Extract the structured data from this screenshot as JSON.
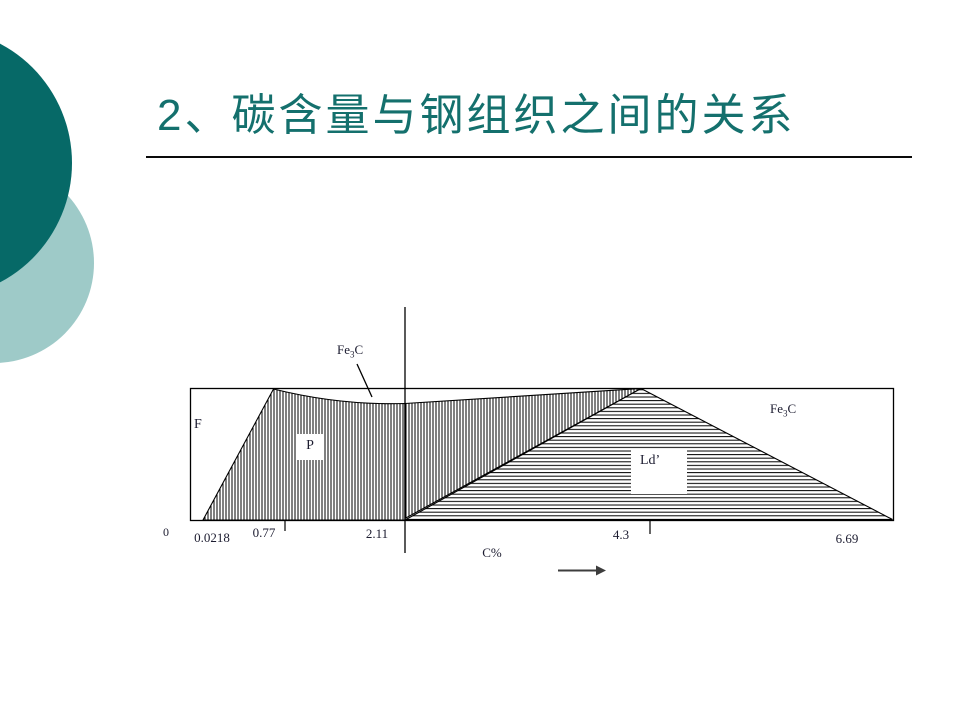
{
  "slide": {
    "title": "2、碳含量与钢组织之间的关系",
    "accent_color": "#14706d",
    "decor": {
      "dark_circle_color": "#066967",
      "light_circle_color": "#9ecac8"
    }
  },
  "diagram": {
    "description_labels": {
      "ferrite": "F",
      "pearlite": "P",
      "ledeburite": "Ld’",
      "cementite": {
        "prefix": "Fe",
        "sub": "3",
        "suffix": "C"
      }
    },
    "axis": {
      "origin": "0",
      "ticks": [
        "0.0218",
        "0.77",
        "2.11",
        "4.3",
        "6.69"
      ],
      "label": "C%"
    }
  }
}
